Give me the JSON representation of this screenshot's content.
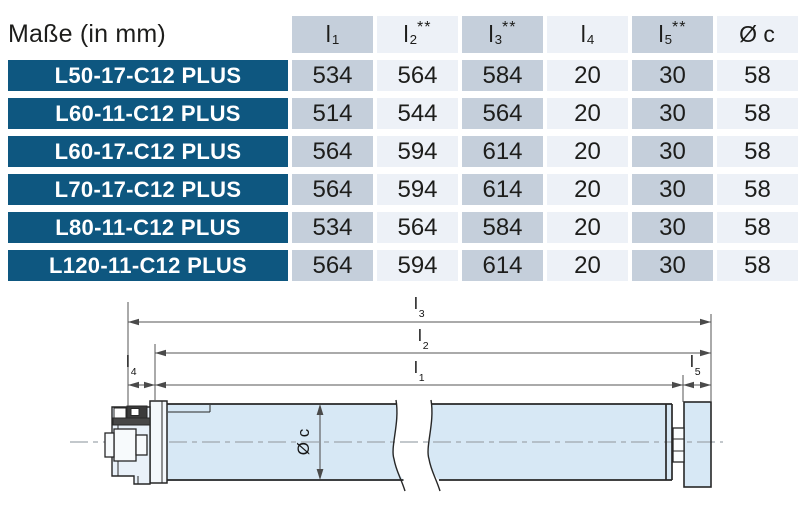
{
  "colors": {
    "brand_blue": "#0e5780",
    "column_shaded": "#c5cfdb",
    "column_light": "#edf1f7",
    "tube_fill": "#d7e8f5",
    "text_dark": "#1d1d1b"
  },
  "table": {
    "caption": "Maße (in mm)",
    "columns": [
      {
        "base": "l",
        "sub": "1",
        "sup": ""
      },
      {
        "base": "l",
        "sub": "2",
        "sup": "**"
      },
      {
        "base": "l",
        "sub": "3",
        "sup": "**"
      },
      {
        "base": "l",
        "sub": "4",
        "sup": ""
      },
      {
        "base": "l",
        "sub": "5",
        "sup": "**"
      },
      {
        "base": "Ø c",
        "sub": "",
        "sup": ""
      }
    ],
    "rows": [
      {
        "model": "L50-17-C12 PLUS",
        "values": [
          "534",
          "564",
          "584",
          "20",
          "30",
          "58"
        ]
      },
      {
        "model": "L60-11-C12 PLUS",
        "values": [
          "514",
          "544",
          "564",
          "20",
          "30",
          "58"
        ]
      },
      {
        "model": "L60-17-C12 PLUS",
        "values": [
          "564",
          "594",
          "614",
          "20",
          "30",
          "58"
        ]
      },
      {
        "model": "L70-17-C12 PLUS",
        "values": [
          "564",
          "594",
          "614",
          "20",
          "30",
          "58"
        ]
      },
      {
        "model": "L80-11-C12 PLUS",
        "values": [
          "534",
          "564",
          "584",
          "20",
          "30",
          "58"
        ]
      },
      {
        "model": "L120-11-C12 PLUS",
        "values": [
          "564",
          "594",
          "614",
          "20",
          "30",
          "58"
        ]
      }
    ]
  },
  "diagram": {
    "labels": {
      "l3": {
        "base": "l",
        "sub": "3"
      },
      "l2": {
        "base": "l",
        "sub": "2"
      },
      "l1": {
        "base": "l",
        "sub": "1"
      },
      "l4": {
        "base": "l",
        "sub": "4"
      },
      "l5": {
        "base": "l",
        "sub": "5"
      },
      "diameter": "Ø c"
    }
  }
}
